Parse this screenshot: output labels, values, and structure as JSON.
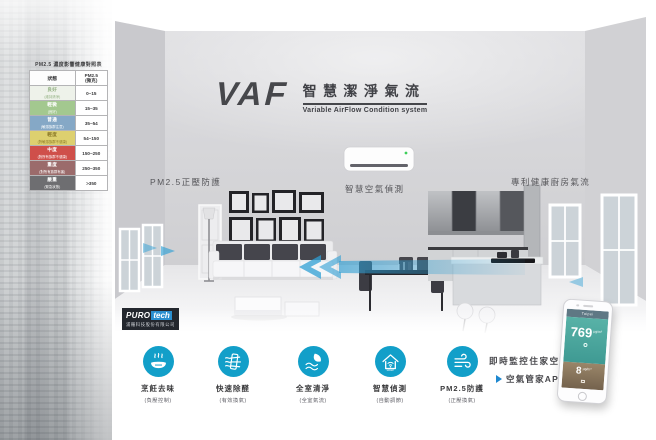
{
  "brand": {
    "logo": "VAF",
    "title_zh": "智慧潔淨氣流",
    "title_en": "Variable AirFlow Condition system"
  },
  "pm_table": {
    "title": "PM2.5 濃度影響健康對照表",
    "col_status": "狀態",
    "col_value_line1": "PM2.5",
    "col_value_line2": "(微克)",
    "rows": [
      {
        "label": "良好",
        "note": "(維持清淨)",
        "range": "0~15",
        "color": "#eef2ea"
      },
      {
        "label": "輕微",
        "note": "(良好)",
        "range": "15~35",
        "color": "#a3c88f"
      },
      {
        "label": "普通",
        "note": "(敏感族群注意)",
        "range": "35~54",
        "color": "#85a8c6"
      },
      {
        "label": "輕度",
        "note": "(對敏感族群不健康)",
        "range": "54~150",
        "color": "#ddd06f"
      },
      {
        "label": "中度",
        "note": "(對所有族群不健康)",
        "range": "150~250",
        "color": "#cf4f4a"
      },
      {
        "label": "重度",
        "note": "(對所有族群有害)",
        "range": "250~350",
        "color": "#9b6b6b"
      },
      {
        "label": "嚴重",
        "note": "(緊急狀態)",
        "range": ">350",
        "color": "#6e6e71"
      }
    ]
  },
  "scene": {
    "label_left": "PM2.5正壓防護",
    "label_center": "智慧空氣偵測",
    "label_right": "專利健康廚房氣流"
  },
  "company": {
    "logo_main": "PURO",
    "logo_accent": "tech",
    "name": "浦羅科技股份有限公司"
  },
  "features": [
    {
      "label": "烹飪去味",
      "note": "(負壓控制)",
      "icon": "cooking-pot-icon"
    },
    {
      "label": "快速除醛",
      "note": "(有效換氣)",
      "icon": "air-filter-icon"
    },
    {
      "label": "全室清淨",
      "note": "(全室氣流)",
      "icon": "leaf-airflow-icon"
    },
    {
      "label": "智慧偵測",
      "note": "(自動調節)",
      "icon": "smart-home-icon",
      "icon_text": "SMART"
    },
    {
      "label": "PM2.5防護",
      "note": "(正壓換氣)",
      "icon": "wind-icon"
    }
  ],
  "app_promo": {
    "line1": "即時監控住家空氣",
    "line2": "空氣管家APP"
  },
  "phone": {
    "app_title": "Taipei",
    "outdoor_value": "769",
    "outdoor_unit": "μg/m³",
    "indoor_value": "8",
    "indoor_unit": "μg/m³"
  },
  "colors": {
    "feature_circle": "#129fc9",
    "arrow_blue": "#2f9fd4",
    "logo_dark": "#46474b",
    "app_top_teal": "#4fae9f",
    "app_bottom_brown": "#8d7b61",
    "purotech_blue": "#2a8fd0"
  }
}
